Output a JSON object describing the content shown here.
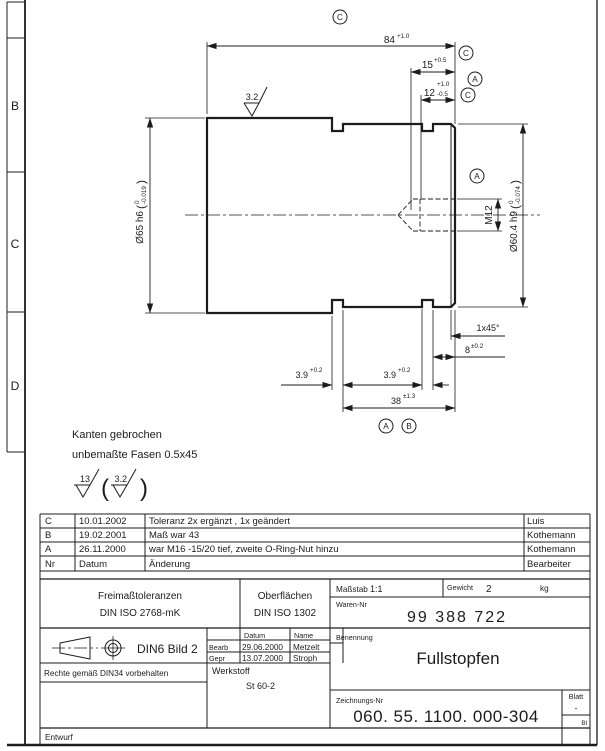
{
  "drawing": {
    "border_letters": {
      "b": "B",
      "c": "C",
      "d": "D"
    },
    "dims": {
      "len84": "84",
      "len84_tol": "+1.0",
      "len15": "15",
      "len15_tol": "+0.5",
      "len12": "12",
      "len12_tol_up": "+1.0",
      "len12_tol_dn": "-0.5",
      "dia65": "Ø65 h6",
      "dia65_tol_up": "0",
      "dia65_tol_dn": "-0.019",
      "dia604": "Ø60.4 h9",
      "dia604_tol_up": "0",
      "dia604_tol_dn": "-0.074",
      "thread": "M12",
      "chamfer": "1x45°",
      "len8": "8",
      "len8_tol": "±0.2",
      "groove1": "3.9",
      "groove1_tol": "+0.2",
      "groove2": "3.9",
      "groove2_tol": "+0.2",
      "len38": "38",
      "len38_tol": "±1.3",
      "surf_top": "3.2",
      "paren_open": "(",
      "paren_close": ")"
    },
    "datum_flags": {
      "top": "C",
      "r1": "C",
      "r2": "A",
      "r3": "C",
      "mid": "A",
      "b1": "A",
      "b2": "B"
    },
    "notes": {
      "line1": "Kanten gebrochen",
      "line2": "unbemaßte Fasen 0.5x45",
      "surf_general": "13",
      "surf_special": "3.2",
      "paren_open": "(",
      "paren_close": ")"
    }
  },
  "revisions": {
    "rows": [
      {
        "nr": "C",
        "datum": "10.01.2002",
        "aenderung": "Toleranz 2x ergänzt , 1x geändert",
        "name": "Luis"
      },
      {
        "nr": "B",
        "datum": "19.02.2001",
        "aenderung": "Maß war 43",
        "name": "Kothemann"
      },
      {
        "nr": "A",
        "datum": "26.11.2000",
        "aenderung": "war M16 -15/20 tief, zweite O-Ring-Nut hinzu",
        "name": "Kothemann"
      },
      {
        "nr": "Nr",
        "datum": "Datum",
        "aenderung": "Änderung",
        "name": "Bearbeiter"
      }
    ]
  },
  "titleblock": {
    "freimass1": "Freimaßtoleranzen",
    "freimass2": "DIN ISO 2768-mK",
    "oberfl1": "Oberflächen",
    "oberfl2": "DIN ISO  1302",
    "massstab_label": "Maßstab",
    "massstab_value": "1:1",
    "gewicht_label": "Gewicht",
    "gewicht_value": "2",
    "gewicht_unit": "kg",
    "warennr_label": "Waren-Nr",
    "warennr_value": "99 388 722",
    "din6": "DIN6 Bild 2",
    "rechte": "Rechte gemäß DIN34 vorbehalten",
    "datum_header": "Datum",
    "name_header": "Name",
    "bearb_label": "Bearb",
    "bearb_datum": "29.06.2000",
    "bearb_name": "Metzelt",
    "gepr_label": "Gepr",
    "gepr_datum": "13.07.2000",
    "gepr_name": "Stroph",
    "werkstoff_label": "Werkstoff",
    "werkstoff_value": "St 60-2",
    "benennung_label": "Benennung",
    "benennung_value": "Fullstopfen",
    "zeichnr_label": "Zeichnungs-Nr",
    "zeichnr_value": "060. 55. 1100. 000-304",
    "blatt_label": "Blatt",
    "blatt_value": "-",
    "blatt_small": "Bl",
    "entwurf": "Entwurf"
  }
}
